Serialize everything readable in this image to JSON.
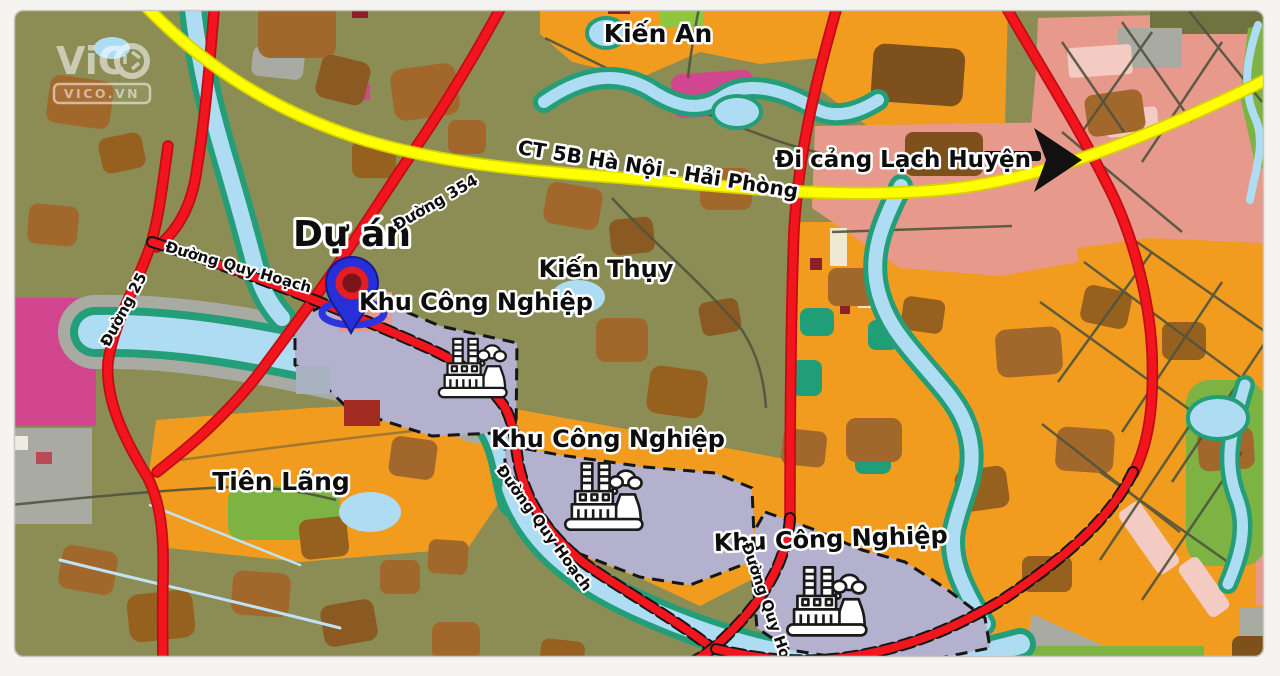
{
  "watermark": {
    "brand": "ViC",
    "brand_full": "VICO",
    "site": "VICO.VN"
  },
  "labels": {
    "kien_an": "Kiến An",
    "kien_thuy": "Kiến Thụy",
    "tien_lang": "Tiên Lãng",
    "project": "Dự án",
    "highway": "CT 5B Hà Nội - Hải Phòng",
    "port_direction": "Đi cảng Lạch Huyện",
    "road_354": "Đường 354",
    "road_25": "Đường 25",
    "planned_road": "Đường Quy Hoạch",
    "industrial_zone": "Khu Công Nghiệp"
  },
  "colors": {
    "land_olive": "#8b8d55",
    "land_orange": "#f29c1f",
    "land_brown": "#a2672a",
    "land_salmon": "#e79a8c",
    "land_magenta": "#d2458f",
    "land_green": "#7cb342",
    "land_grey": "#a9aba3",
    "industrial_zone_fill": "#b3b1cd",
    "water_blue": "#aedcf2",
    "riverbank_teal": "#249e78",
    "road_red": "#f2151d",
    "highway_yellow": "#ffff00",
    "pin_blue": "#2730d8",
    "pin_ring_red": "#e21d25"
  }
}
